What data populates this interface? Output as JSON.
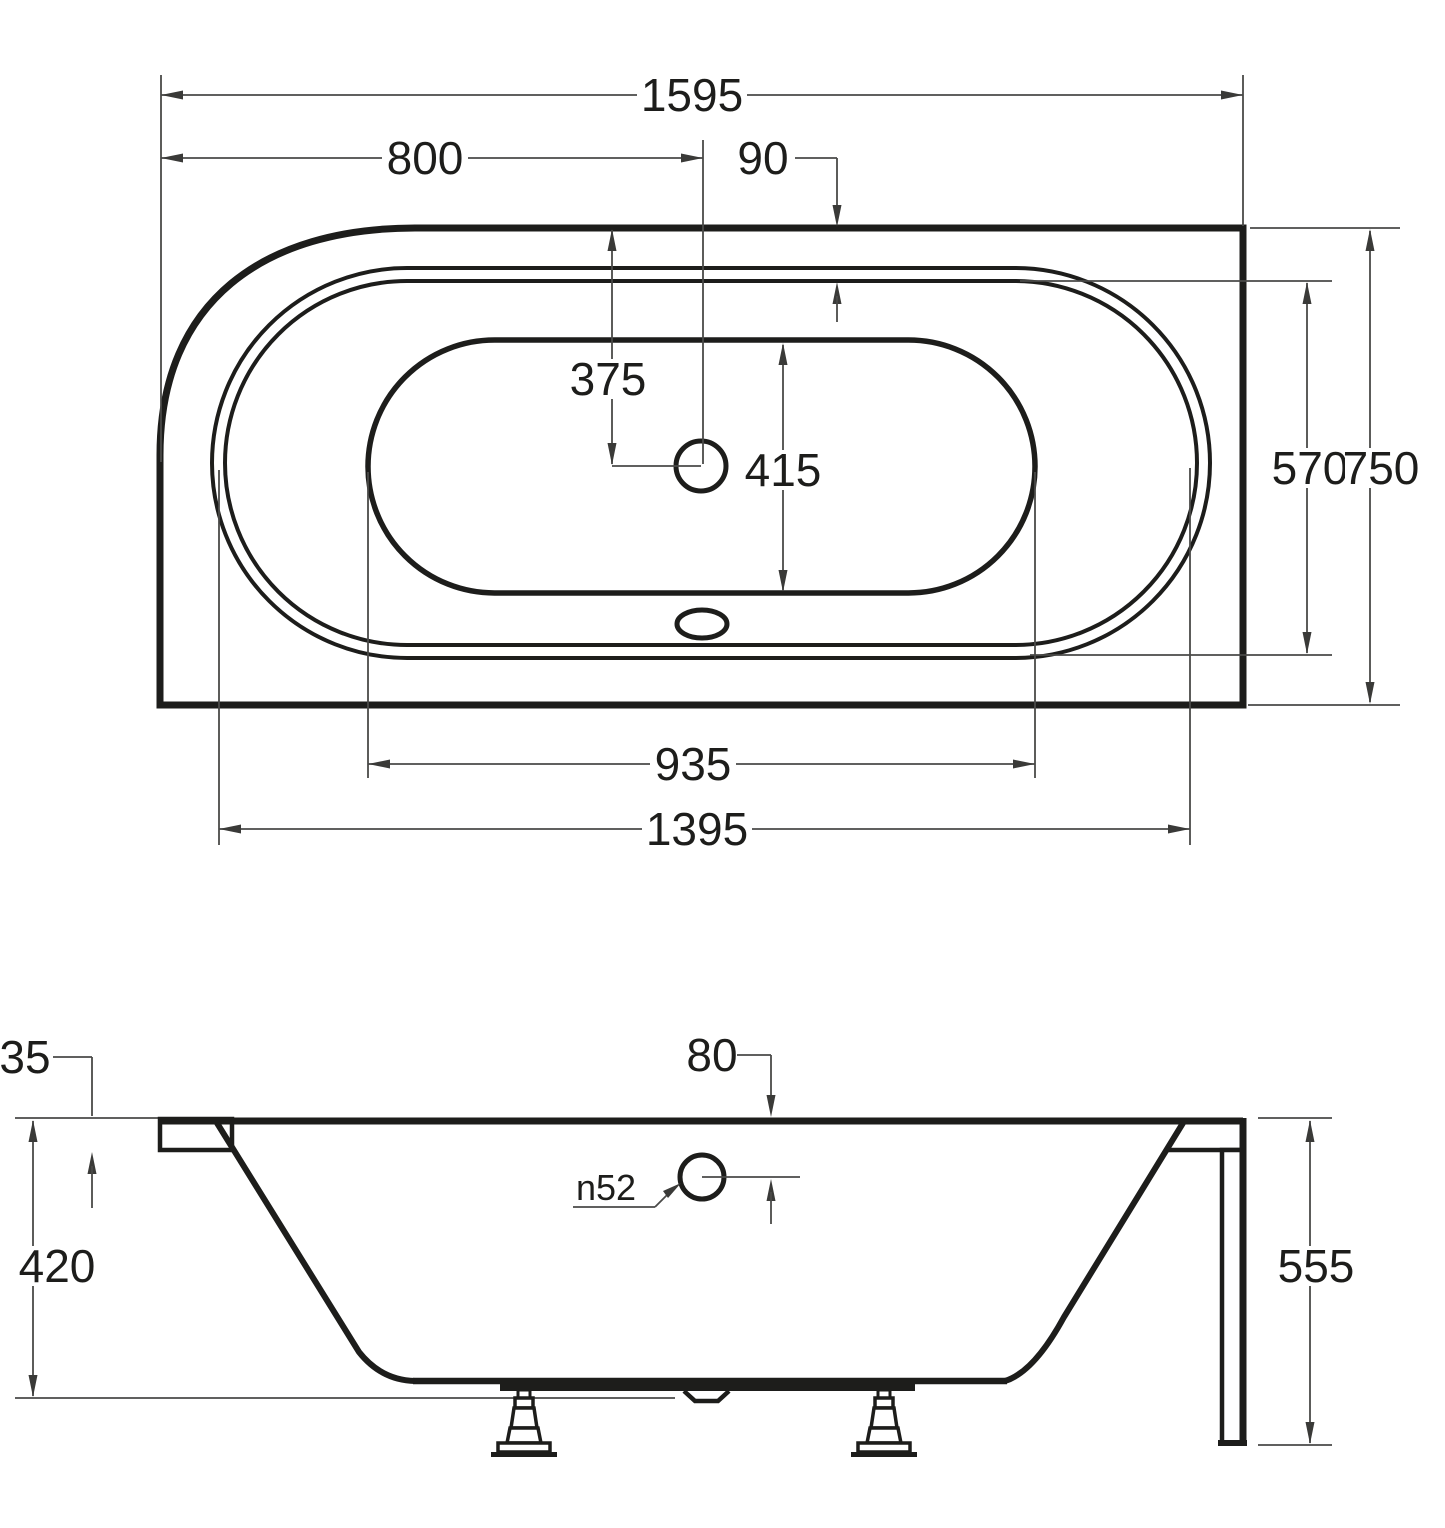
{
  "colors": {
    "ink": "#1d1d1b",
    "thin_line": "#4a4a48",
    "background": "#ffffff"
  },
  "top_view": {
    "title": "bathtub plan view",
    "dims": {
      "overall_length": "1595",
      "drain_center_from_left": "800",
      "rim_width_at_top": "90",
      "drain_center_from_top_edge": "375",
      "basin_inner_width": "415",
      "rim_inner_width": "570",
      "overall_width": "750",
      "basin_bottom_length": "935",
      "rim_inner_length": "1395"
    }
  },
  "side_view": {
    "title": "bathtub side elevation",
    "dims": {
      "rim_lip_height": "35",
      "shell_height": "420",
      "overflow_center_from_rim": "80",
      "overflow_hole_diameter": "n52",
      "total_height_with_panel": "555"
    }
  }
}
